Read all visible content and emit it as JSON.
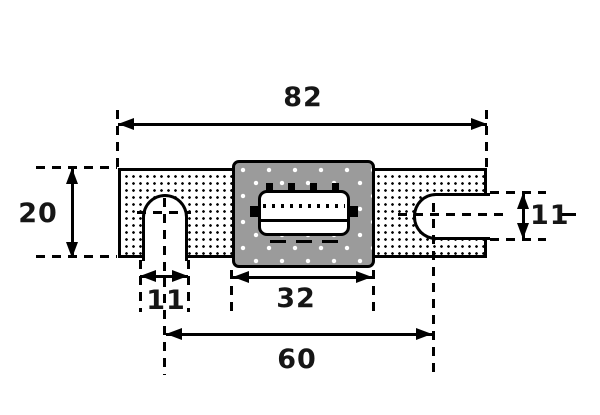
{
  "colors": {
    "line": "#000000",
    "block_fill": "#9b9b9b",
    "background": "#ffffff"
  },
  "dimensions": {
    "overall_length": "82",
    "body_width": "20",
    "left_slot_width": "11",
    "center_block_length": "32",
    "mount_hole_spacing": "60",
    "right_slot_width": "11"
  }
}
